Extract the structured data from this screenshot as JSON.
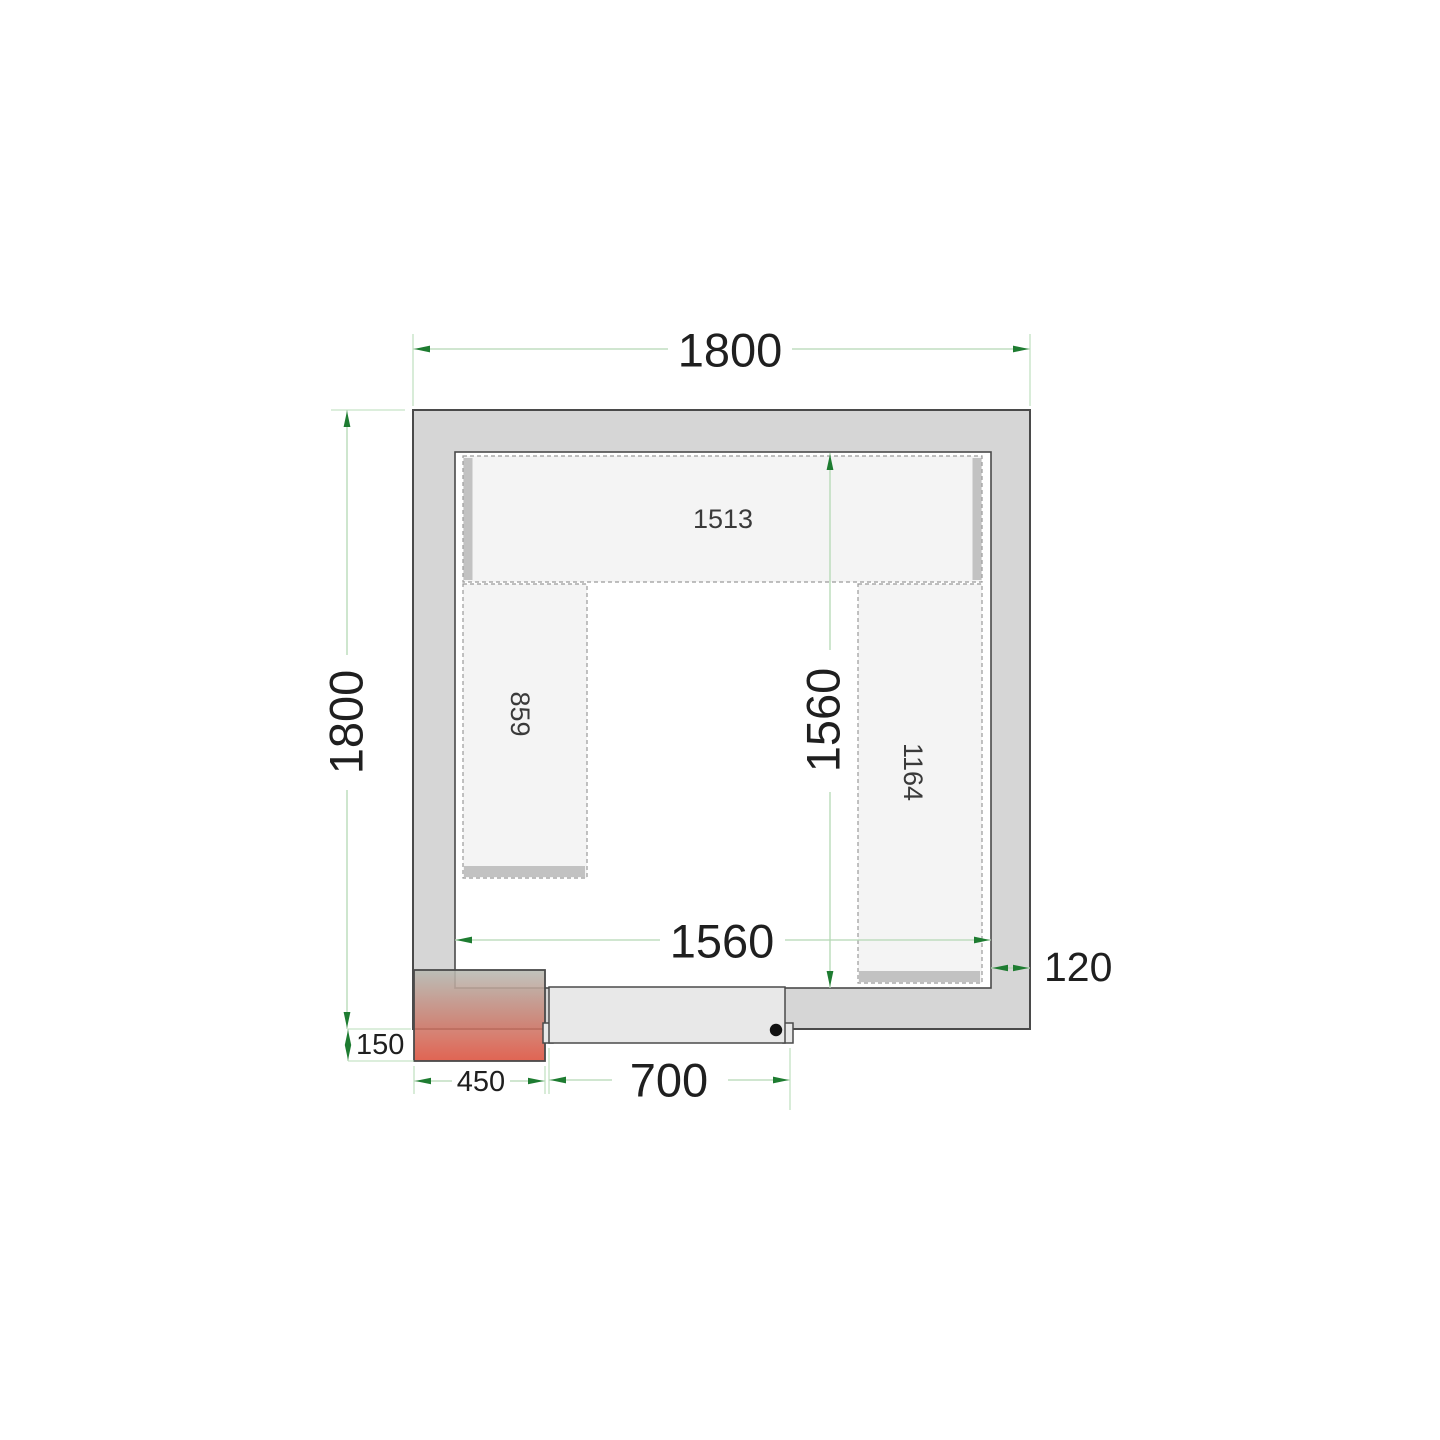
{
  "plan": {
    "dimensions": {
      "outer_width": "1800",
      "outer_depth": "1800",
      "inner_width": "1560",
      "inner_depth": "1560",
      "wall_thickness": "120",
      "door_width": "700",
      "cooling_unit_width": "450",
      "cooling_unit_protrusion": "150"
    },
    "shelf_labels": {
      "top": "1513",
      "left": "859",
      "right": "1164"
    },
    "colors": {
      "wall_fill": "#d6d6d6",
      "wall_stroke": "#4a4a4a",
      "shelf_fill": "#f4f4f4",
      "shelf_bar": "#c2c2c2",
      "door_fill": "#e8e8e8",
      "unit_gradient_top": "#b7bbb3",
      "unit_gradient_bottom": "#dc4f3b",
      "dimension_line": "#b4d8b4",
      "dimension_arrow": "#1e7c31",
      "text": "#1f1f1f"
    }
  }
}
